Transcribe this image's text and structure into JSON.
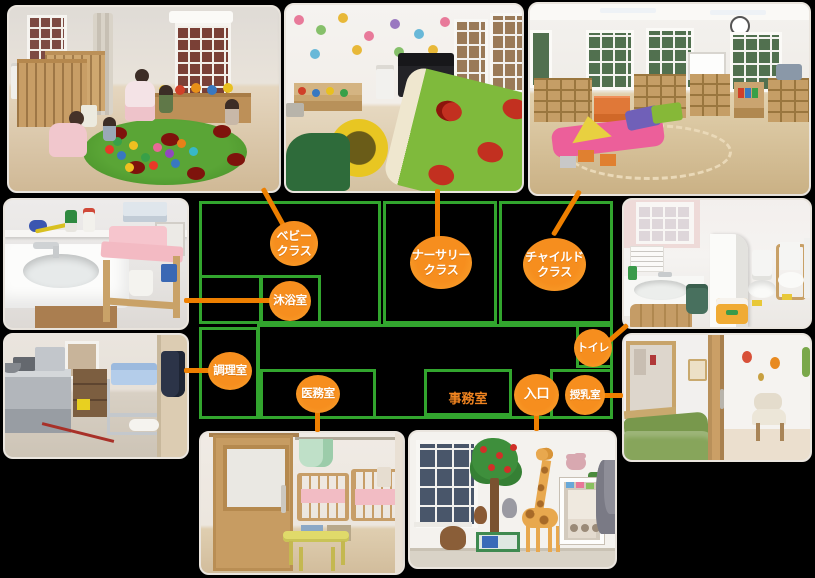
{
  "colors": {
    "background": "#000000",
    "plan_line": "#32a52e",
    "bubble_fill": "#f68e1e",
    "bubble_rim": "#ffb24d",
    "bubble_text": "#ffffff",
    "connector": "#ee7f00",
    "office_text": "#f08420",
    "photo_border": "#eae5de"
  },
  "plan": {
    "class_labels": [
      {
        "id": "baby",
        "line1": "ベビー",
        "line2": "クラス"
      },
      {
        "id": "nursery",
        "line1": "ナーサリー",
        "line2": "クラス"
      },
      {
        "id": "child",
        "line1": "チャイルド",
        "line2": "クラス"
      }
    ],
    "room_labels": {
      "bath": "沐浴室",
      "kitchen": "調理室",
      "medical": "医務室",
      "office": "事務室",
      "entrance": "入口",
      "toilet": "トイレ",
      "nursing": "授乳室"
    }
  },
  "photos": [
    {
      "id": "baby-class",
      "scene": "baby class room with wooden cribs, caregivers and infants playing on a ladybug rug"
    },
    {
      "id": "nursery-class",
      "scene": "nursery class playroom with wall stickers, piano and ladybug play mat"
    },
    {
      "id": "child-class",
      "scene": "child class room with cubby shelves, windows and soft play blocks"
    },
    {
      "id": "bath-room",
      "scene": "baby bathing room with white sink and pink changing table"
    },
    {
      "id": "kitchen",
      "scene": "kitchen with stainless counters and meal cart"
    },
    {
      "id": "toilet",
      "scene": "toilet room with toddler toilets and hand-washing sink"
    },
    {
      "id": "nursing-room",
      "scene": "nursing room with green sofa and chair"
    },
    {
      "id": "medical-room",
      "scene": "medical room behind wooden door with cribs and yellow table"
    },
    {
      "id": "entrance",
      "scene": "entrance hallway with animal murals and glass door"
    }
  ]
}
